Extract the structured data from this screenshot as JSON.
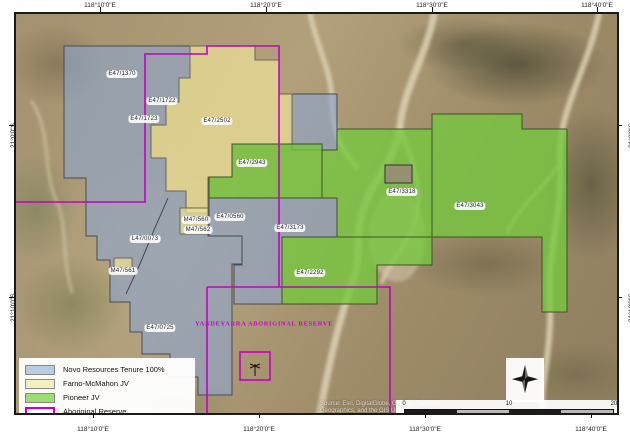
{
  "map": {
    "type": "tenement-location-map",
    "basemap": "satellite imagery",
    "reserve_label": "YANDEYARRA ABORIGINAL RESERVE",
    "reserve_outline_color": "#c400c4"
  },
  "coordinates": {
    "top": [
      "118°10'0\"E",
      "118°20'0\"E",
      "118°30'0\"E",
      "118°40'0\"E"
    ],
    "bottom": [
      "118°10'0\"E",
      "118°20'0\"E",
      "118°30'0\"E",
      "118°40'0\"E"
    ],
    "left": [
      "21°0'0\"S",
      "21°10'0\"S"
    ],
    "right": [
      "21°0'0\"S",
      "21°10'0\"S"
    ]
  },
  "tenements": [
    {
      "label": "E47/1370",
      "owner": "Novo Resources Tenure 100%"
    },
    {
      "label": "E47/1722",
      "owner": "Novo Resources Tenure 100%"
    },
    {
      "label": "E47/1723",
      "owner": "Novo Resources Tenure 100%"
    },
    {
      "label": "E47/2502",
      "owner": "Farno-McMahon JV"
    },
    {
      "label": "E47/2943",
      "owner": "Pioneer JV"
    },
    {
      "label": "E47/3318",
      "owner": "Pioneer JV"
    },
    {
      "label": "E47/3043",
      "owner": "Pioneer JV"
    },
    {
      "label": "E47/3173",
      "owner": "Novo Resources Tenure 100%"
    },
    {
      "label": "E47/2292",
      "owner": "Pioneer JV"
    },
    {
      "label": "M47/560",
      "owner": "Farno-McMahon JV"
    },
    {
      "label": "M47/562",
      "owner": "Farno-McMahon JV"
    },
    {
      "label": "E47/0560",
      "owner": "Novo Resources Tenure 100%"
    },
    {
      "label": "M47/561",
      "owner": "Farno-McMahon JV"
    },
    {
      "label": "L47/0073",
      "owner": "Novo Resources Tenure 100%"
    },
    {
      "label": "E47/0725",
      "owner": "Novo Resources Tenure 100%"
    }
  ],
  "legend": {
    "items": [
      {
        "label": "Novo Resources Tenure 100%",
        "color": "#b8cce4"
      },
      {
        "label": "Farno-McMahon JV",
        "color": "#f4f0c0"
      },
      {
        "label": "Pioneer JV",
        "color": "#9fdc73"
      },
      {
        "label": "Aboriginal Reserve",
        "color": "#c400c4"
      }
    ]
  },
  "scalebar": {
    "ticks": [
      "0",
      "10",
      "20"
    ],
    "unit": "Kilometers"
  },
  "attribution": {
    "line1": "Source: Esri, DigitalGlobe, GeoEye, Earthstar",
    "line2": "Geographics, and the GIS User Community"
  }
}
